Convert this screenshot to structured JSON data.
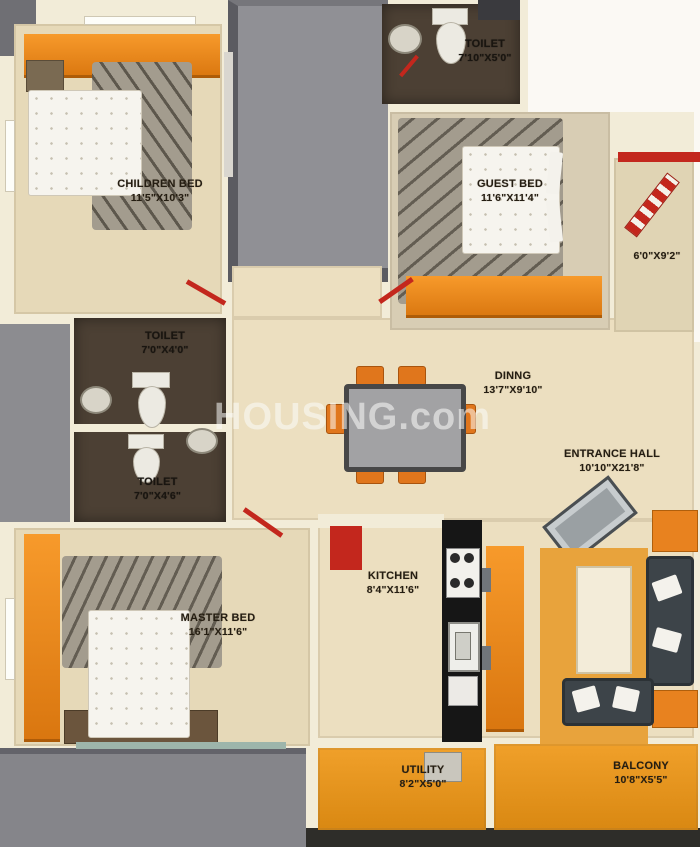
{
  "watermark": "HOUSING.com",
  "colors": {
    "floor_beige": "#e6d9b8",
    "wall_cream": "#f2ecd8",
    "wardrobe_orange": "#ef8a1c",
    "balcony_orange": "#ea9820",
    "toilet_brown": "#4c4034",
    "door_red": "#c3271d",
    "void_gray": "#909095",
    "sofa_dark": "#3d4449",
    "hall_rug_orange": "#e8a33c"
  },
  "rooms": {
    "children_bed": {
      "name": "CHILDREN BED",
      "dims": "11'5\"X10'3\""
    },
    "toilet_top": {
      "name": "TOILET",
      "dims": "7'10\"X5'0\""
    },
    "guest_bed": {
      "name": "GUEST BED",
      "dims": "11'6\"X11'4\""
    },
    "side_balcony": {
      "dims": "6'0\"X9'2\""
    },
    "toilet_mid": {
      "name": "TOILET",
      "dims": "7'0\"X4'0\""
    },
    "toilet_lower": {
      "name": "TOILET",
      "dims": "7'0\"X4'6\""
    },
    "dining": {
      "name": "DINNG",
      "dims": "13'7\"X9'10\""
    },
    "entrance_hall": {
      "name": "ENTRANCE HALL",
      "dims": "10'10\"X21'8\""
    },
    "kitchen": {
      "name": "KITCHEN",
      "dims": "8'4\"X11'6\""
    },
    "master_bed": {
      "name": "MASTER BED",
      "dims": "16'1\"X11'6\""
    },
    "utility": {
      "name": "UTILITY",
      "dims": "8'2\"X5'0\""
    },
    "balcony": {
      "name": "BALCONY",
      "dims": "10'8\"X5'5\""
    }
  }
}
